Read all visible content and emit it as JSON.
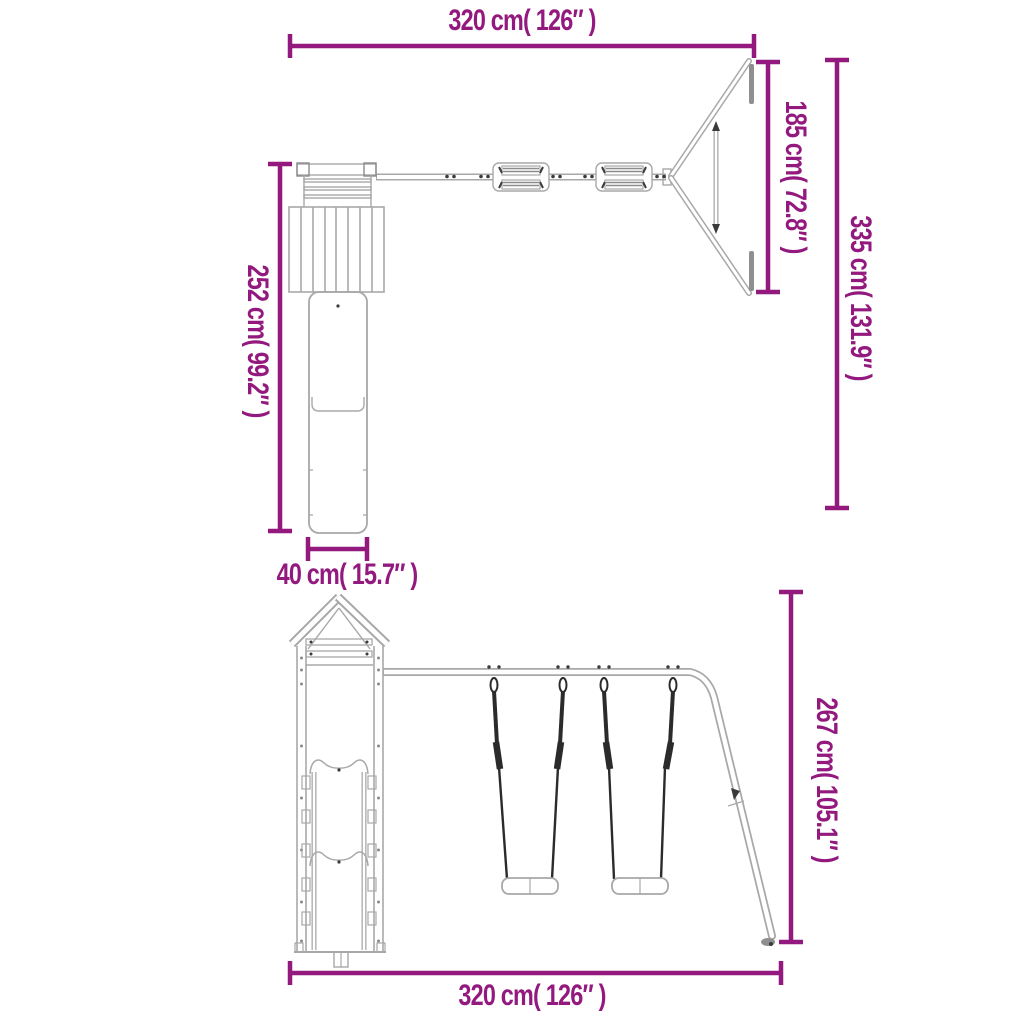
{
  "colors": {
    "accent": "#93197f",
    "line": "#a8a8a8",
    "line_strong": "#8c8c8c",
    "metal": "#8f8f8f",
    "dark": "#3a3a3a",
    "rope": "#2b2b2b",
    "background": "#ffffff"
  },
  "top_view": {
    "dim_width": "320 cm( 126″ )",
    "dim_frame_depth": "185 cm( 72.8″ )",
    "dim_total_depth": "335 cm( 131.9″ )",
    "dim_tower_depth": "252 cm( 99.2″ )",
    "dim_slide_width": "40 cm( 15.7″ )"
  },
  "front_view": {
    "dim_height": "267 cm( 105.1″ )",
    "dim_width": "320 cm( 126″ )"
  }
}
